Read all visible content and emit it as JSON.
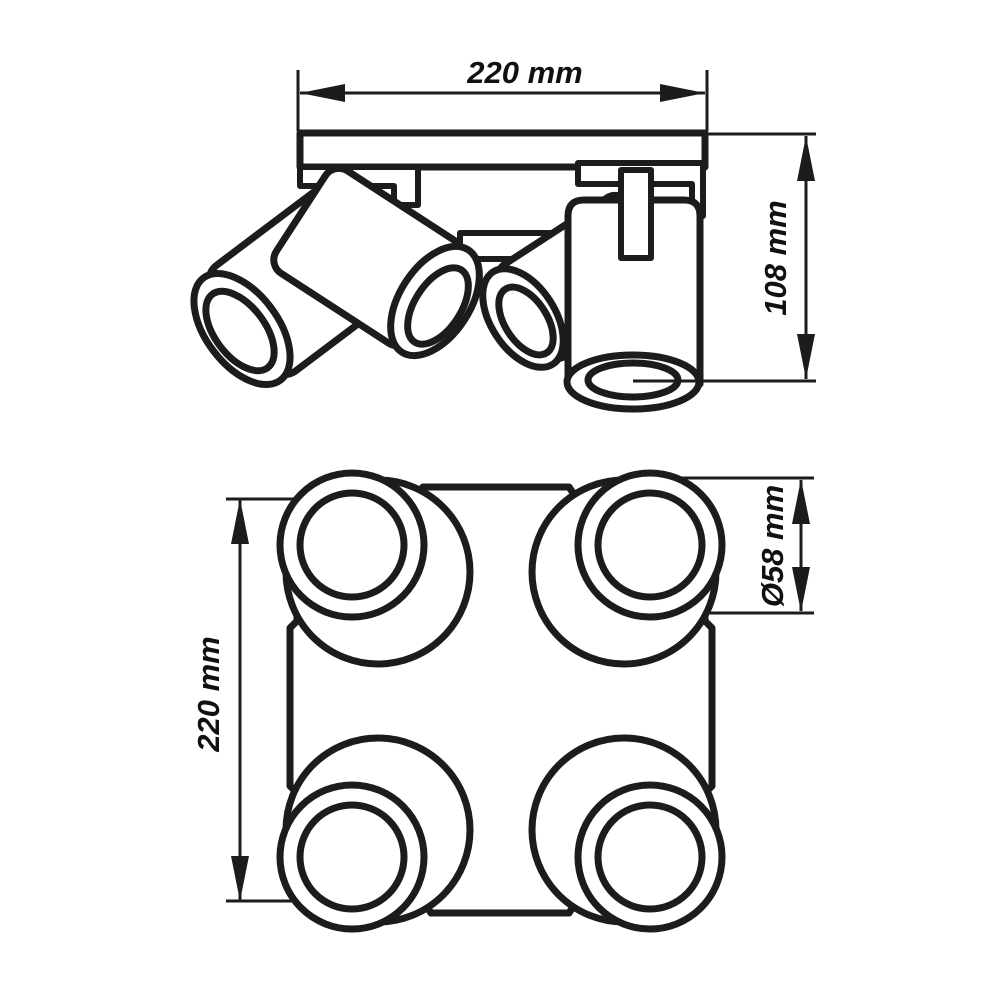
{
  "drawing": {
    "side_view": {
      "width_label": "220 mm",
      "height_label": "108 mm"
    },
    "plan_view": {
      "height_label": "220 mm",
      "diameter_label": "Ø58 mm"
    }
  },
  "colors": {
    "line": "#1c1c1c",
    "background": "#ffffff"
  }
}
